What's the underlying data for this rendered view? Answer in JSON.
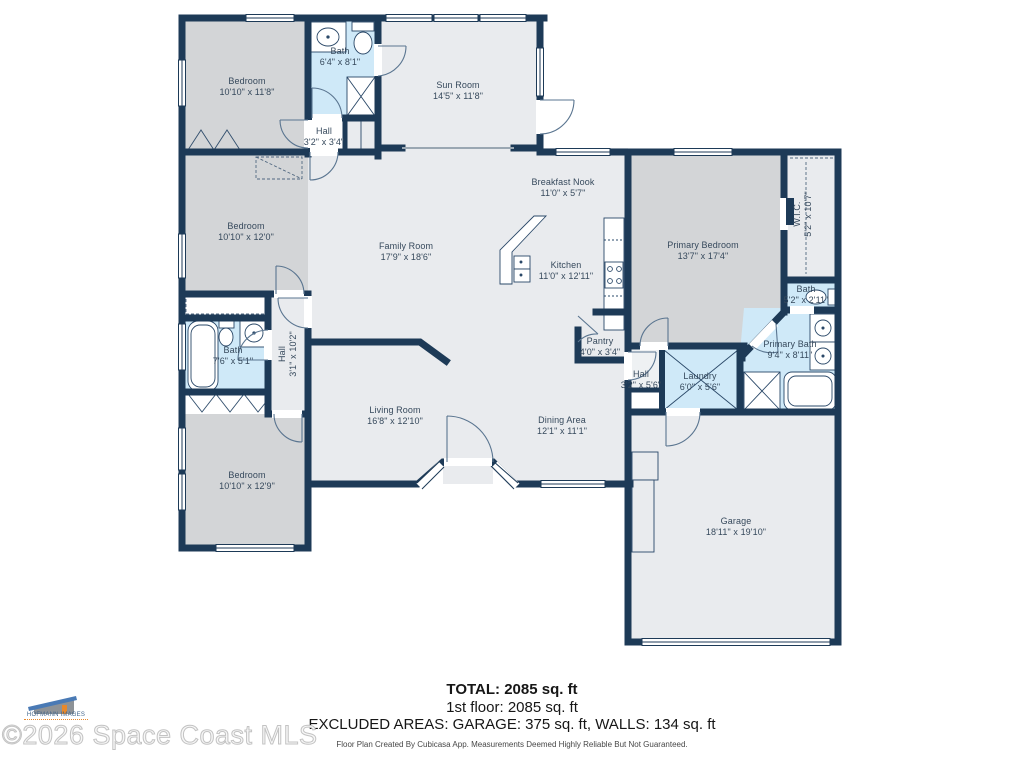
{
  "plan": {
    "rooms": [
      {
        "name": "Bedroom",
        "dims": "10'10\" x 11'8\""
      },
      {
        "name": "Bath",
        "dims": "6'4\" x 8'1\""
      },
      {
        "name": "Hall",
        "dims": "3'2\" x 3'4\""
      },
      {
        "name": "Sun Room",
        "dims": "14'5\" x 11'8\""
      },
      {
        "name": "Breakfast Nook",
        "dims": "11'0\" x 5'7\""
      },
      {
        "name": "Family Room",
        "dims": "17'9\" x 18'6\""
      },
      {
        "name": "Kitchen",
        "dims": "11'0\" x 12'11\""
      },
      {
        "name": "Primary Bedroom",
        "dims": "13'7\" x 17'4\""
      },
      {
        "name": "W.I.C.",
        "dims": "5'2\" x 10'7\""
      },
      {
        "name": "Bath",
        "dims": "5'2\" x 2'11\""
      },
      {
        "name": "Primary Bath",
        "dims": "9'4\" x 8'11\""
      },
      {
        "name": "Bedroom",
        "dims": "10'10\" x 12'0\""
      },
      {
        "name": "Bath",
        "dims": "7'6\" x 5'1\""
      },
      {
        "name": "Hall",
        "dims": "3'1\" x 10'2\""
      },
      {
        "name": "Living Room",
        "dims": "16'8\" x 12'10\""
      },
      {
        "name": "Dining Area",
        "dims": "12'1\" x 11'1\""
      },
      {
        "name": "Pantry",
        "dims": "4'0\" x 3'4\""
      },
      {
        "name": "Hall",
        "dims": "3'2\" x 5'6\""
      },
      {
        "name": "Laundry",
        "dims": "6'0\" x 5'6\""
      },
      {
        "name": "Bedroom",
        "dims": "10'10\" x 12'9\""
      },
      {
        "name": "Garage",
        "dims": "18'11\" x 19'10\""
      }
    ],
    "footer": {
      "total": "TOTAL: 2085 sq. ft",
      "first_floor": "1st floor: 2085 sq. ft",
      "excluded": "EXCLUDED AREAS: GARAGE: 375 sq. ft, WALLS: 134 sq. ft",
      "disclaimer": "Floor Plan Created By Cubicasa App. Measurements Deemed Highly Reliable But Not Guaranteed."
    },
    "watermark": {
      "copyright": "©2026 Space Coast MLS",
      "logo_text": "HOFMANN IMAGES"
    },
    "colors": {
      "wall": "#1d3a57",
      "room_light": "#e9ebee",
      "room_gray": "#d3d5d7",
      "room_wet": "#cfe9f8"
    }
  }
}
